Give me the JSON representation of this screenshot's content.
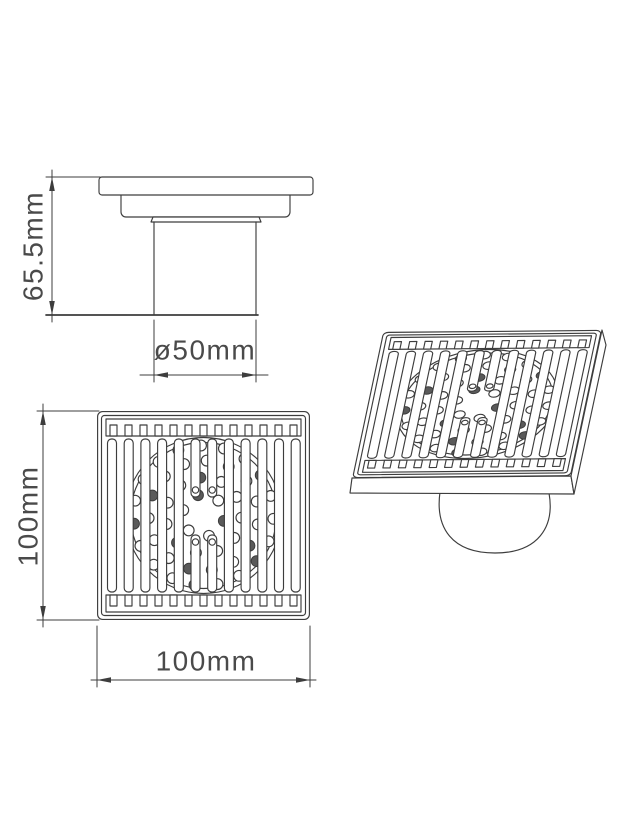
{
  "background": "#ffffff",
  "line_color": "#3d3d3d",
  "text_color": "#4a4a4a",
  "hole_shade_color": "#5a5a5a",
  "drawing_subject": "square floor drain with grate cover and outlet pipe",
  "dimensions": {
    "overall_height": "65.5mm",
    "pipe_diameter": "ø50mm",
    "grate_height": "100mm",
    "grate_width": "100mm"
  },
  "grate": {
    "outer_size": [
      213,
      209
    ],
    "rail_slots": 13,
    "slat_count": 12,
    "slat_width": 9,
    "slat_pitch": 16.7,
    "slat_start": 10.5,
    "slat_top": 28,
    "slat_bottom": 181,
    "center_gap_top": 86,
    "center_gap_bottom": 124,
    "strainer_radius_outer": 78,
    "strainer_radius_inner": 73,
    "hole_radius": 5.4,
    "hole_rings": [
      {
        "r": 21,
        "n": 6
      },
      {
        "r": 38,
        "n": 11
      },
      {
        "r": 55,
        "n": 15
      },
      {
        "r": 70,
        "n": 19
      }
    ]
  }
}
